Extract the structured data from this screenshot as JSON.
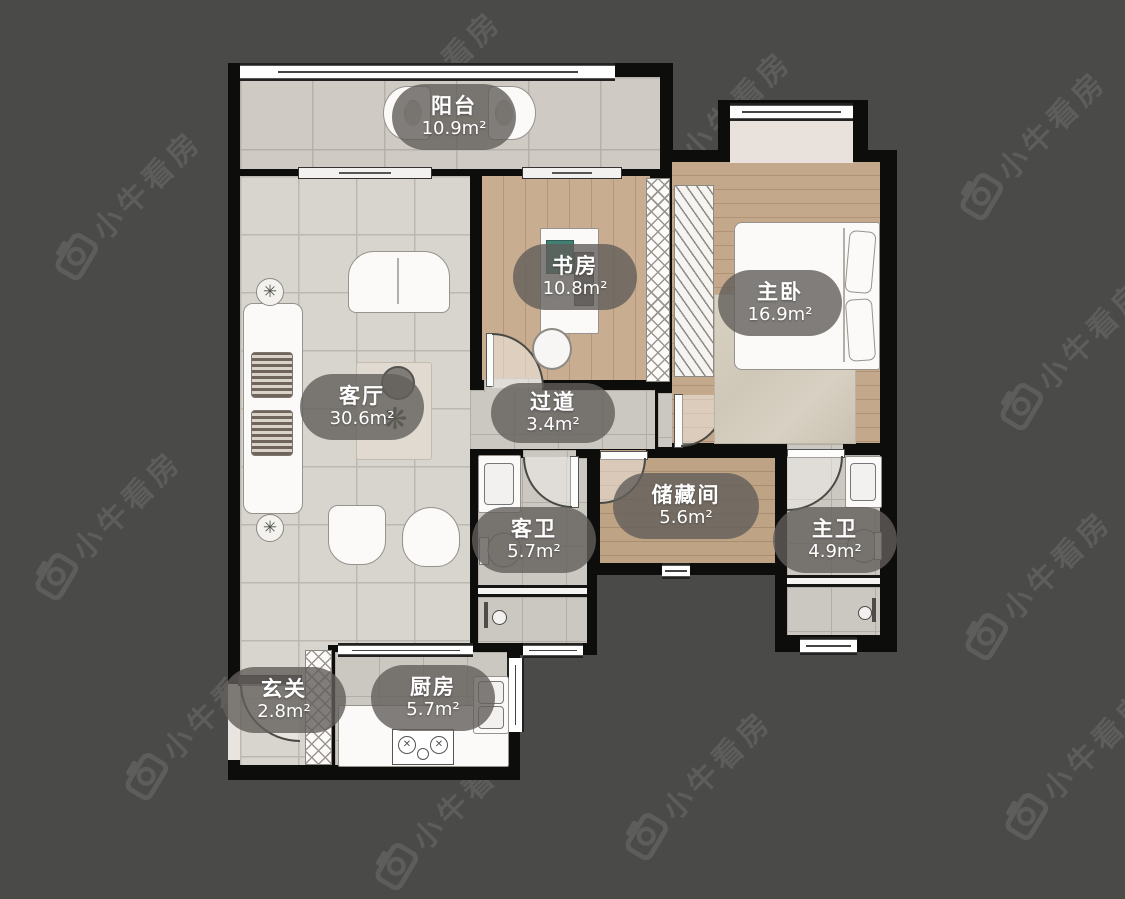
{
  "watermark": {
    "text": "小牛看房"
  },
  "plan": {
    "rooms": [
      {
        "id": "balcony",
        "name": "阳台",
        "area": "10.9m²"
      },
      {
        "id": "living-room",
        "name": "客厅",
        "area": "30.6m²"
      },
      {
        "id": "study",
        "name": "书房",
        "area": "10.8m²"
      },
      {
        "id": "master-bedroom",
        "name": "主卧",
        "area": "16.9m²"
      },
      {
        "id": "hallway",
        "name": "过道",
        "area": "3.4m²"
      },
      {
        "id": "storage-room",
        "name": "储藏间",
        "area": "5.6m²"
      },
      {
        "id": "guest-bathroom",
        "name": "客卫",
        "area": "5.7m²"
      },
      {
        "id": "master-bathroom",
        "name": "主卫",
        "area": "4.9m²"
      },
      {
        "id": "entry",
        "name": "玄关",
        "area": "2.8m²"
      },
      {
        "id": "kitchen",
        "name": "厨房",
        "area": "5.7m²"
      }
    ]
  },
  "colors": {
    "background": "#4a4a49",
    "wall": "#0d0d0c",
    "tile": "#d8d4ce",
    "wood": "#c3a88b",
    "bath_tile": "#cbc7c1",
    "label_bg": "rgba(97,94,90,0.8)",
    "label_text": "#ffffff",
    "watermark": "#5d5d5c"
  }
}
